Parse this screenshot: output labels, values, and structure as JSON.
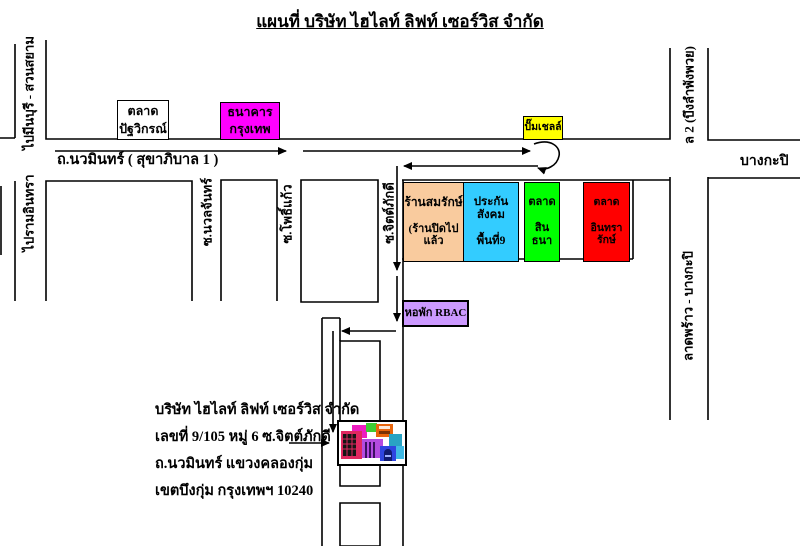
{
  "title": "แผนที่ บริษัท ไฮไลท์ ลิฟท์ เซอร์วิส จำกัด",
  "roads": {
    "min_buri": "ไปมีนบุรี - สวนสยาม",
    "bueng_lam_phang_phuai": "ล 2 (บึงลำพังพวย)",
    "navamin": "ถ.นวมินทร์ ( สุขาภิบาล 1 )",
    "bang_kapi": "บางกะปิ",
    "ram_intra": "ไปรามอินทรา",
    "nuan_chan": "ซ.นวลจันทร์",
    "pho_kaeo": "ซ.โพธิ์แก้ว",
    "chit_phakdi": "ซ.จิตต์ภักดี",
    "lat_phrao": "ลาดพร้าว - บางกะปิ"
  },
  "landmarks": {
    "patwikorn_market": {
      "line1": "ตลาด",
      "line2": "ปัฐวิกรณ์",
      "color": "#FFFFFF"
    },
    "bangkok_bank": {
      "line1": "ธนาคาร",
      "line2": "กรุงเทพ",
      "color": "#FF00FF"
    },
    "shell_station": {
      "label": "ปั๊มเชลล์",
      "color": "#FFFF00"
    },
    "somrak_shop": {
      "line1": "ร้านสมรักษ์",
      "line2": "(ร้านปิดไปแล้ว",
      "color": "#F9CB9E"
    },
    "social_security": {
      "line1": "ประกันสังคม",
      "line2": "พื้นที่9",
      "color": "#33CCFF"
    },
    "sinthana_market": {
      "line1": "ตลาด",
      "line2": "สินธนา",
      "color": "#00FF00"
    },
    "intharaluck_market": {
      "line1": "ตลาด",
      "line2": "อินทรารักษ์",
      "color": "#FF0000"
    },
    "rbac_dorm": {
      "label": "หอพัก RBAC",
      "color": "#CC99FF"
    }
  },
  "company": {
    "line1": "บริษัท ไฮไลท์ ลิฟท์ เซอร์วิส จำกัด",
    "line2": "เลขที่ 9/105 หมู่ 6 ซ.จิตต์ภักดี",
    "line3": "ถ.นวมินทร์ แขวงคลองกุ่ม",
    "line4": "เขตบึงกุ่ม กรุงเทพฯ 10240"
  },
  "route_color": "#000000"
}
